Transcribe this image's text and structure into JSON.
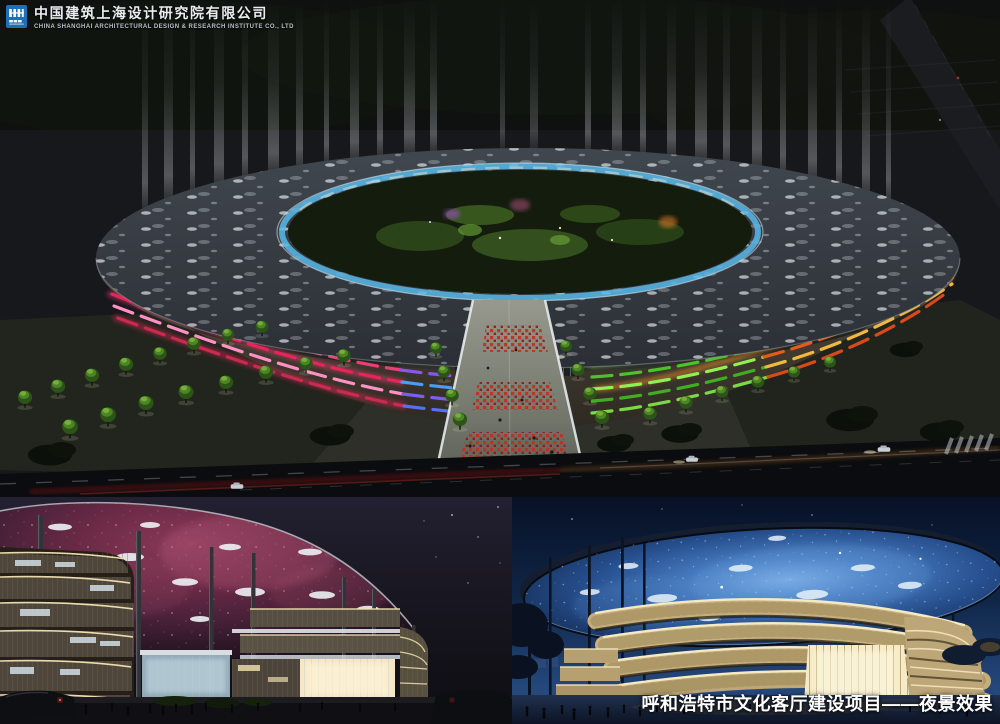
{
  "header": {
    "company_name_cn": "中国建筑上海设计研究院有限公司",
    "company_name_en": "CHINA SHANGHAI ARCHITECTURAL DESIGN & RESEARCH INSTITUTE CO., LTD"
  },
  "caption": {
    "text": "呼和浩特市文化客厅建设项目——夜景效果"
  },
  "panels": {
    "main": {
      "alt": "Aerial night rendering: elliptical ring cultural complex with colored facade light bands, sky light beams, tree-lined plaza and road"
    },
    "bottom_left": {
      "alt": "Street-level night rendering: nebula-lit canopy soffit over curved louvered buildings with visitors"
    },
    "bottom_right": {
      "alt": "Street-level night rendering: blue star-lit elliptical disc roof over warm glowing curved facades"
    }
  },
  "colors": {
    "logo_blue": "#1e6fb5",
    "sky_dark": "#14161a",
    "deep_blue_sky": "#0a1c3e",
    "accent_pink": "#f23b78",
    "accent_green": "#5fd838",
    "accent_orange": "#f09828",
    "accent_glass_blue": "#57b8e8",
    "caption_white": "#ffffff"
  }
}
